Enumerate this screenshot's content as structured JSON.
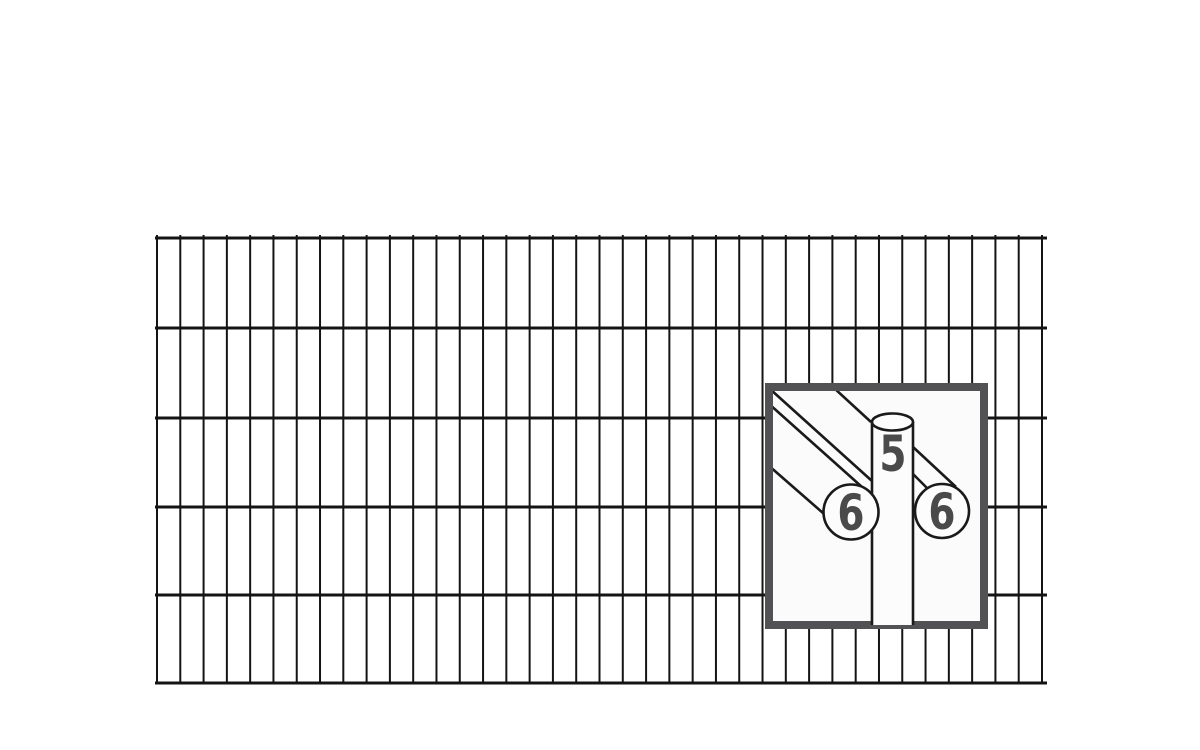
{
  "illustration": {
    "detail_labels": {
      "vertical_wire_diameter": "5",
      "front_horizontal_wire_diameter": "6",
      "back_horizontal_wire_diameter": "6"
    }
  },
  "colors": {
    "background": "#ffffff",
    "wire": "#141414",
    "callout_border": "#525254",
    "callout_fill": "#fbfbfb",
    "cylinder_fill": "#fcfcfc",
    "label_text": "#4a4a4a"
  },
  "mesh": {
    "left": 155,
    "right": 1047,
    "horizontal_wire_y": [
      238,
      328,
      418,
      507,
      595,
      683
    ],
    "horizontal_wire_width": 3,
    "vertical_wire_first_x": 157,
    "vertical_wire_last_x": 1042,
    "vertical_wire_count": 39,
    "vertical_wire_width": 2,
    "vertical_top": 235,
    "vertical_bottom": 684
  }
}
